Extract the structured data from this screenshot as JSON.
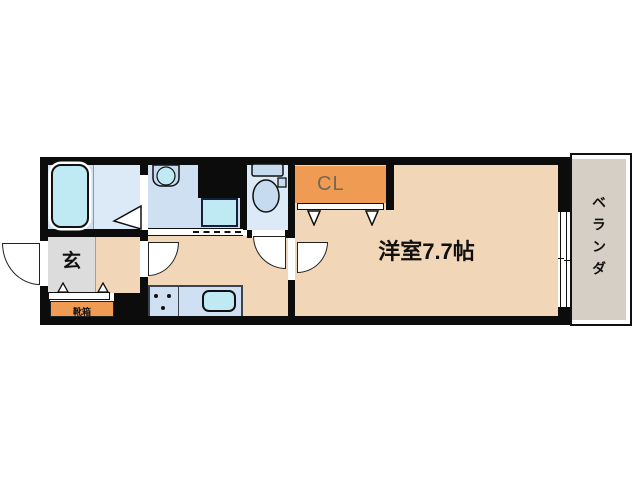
{
  "floorplan": {
    "labels": {
      "closet": "CL",
      "main_room": "洋室7.7帖",
      "veranda": "ベランダ",
      "entrance": "玄",
      "shoe_box": "靴箱"
    },
    "colors": {
      "wall": "#0c0c0c",
      "beige": "#f2d6b8",
      "orange": "#ef9b53",
      "blue": "#cfe0f3",
      "blue_light": "#dceaf8",
      "cyan": "#bfeaf3",
      "fixture_blue": "#c6daf0",
      "gray": "#dcdcdd",
      "veranda_gray": "#d6cfc6",
      "cl_text": "#77674f",
      "outline": "#111111"
    }
  }
}
